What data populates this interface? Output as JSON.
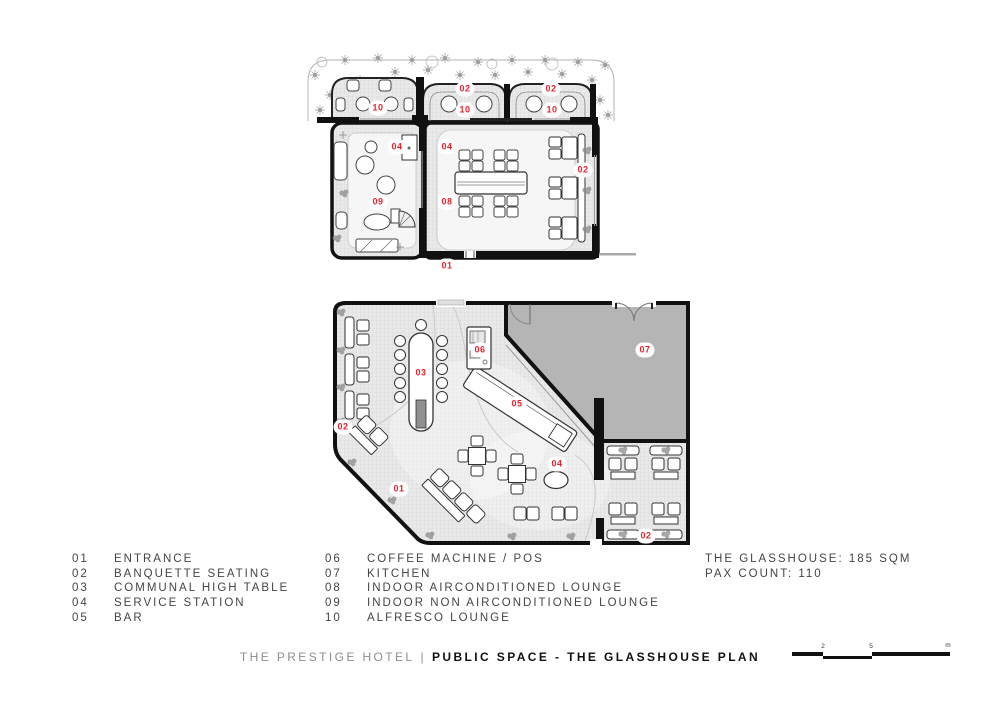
{
  "legend": {
    "items_left": [
      {
        "num": "01",
        "label": "ENTRANCE"
      },
      {
        "num": "02",
        "label": "BANQUETTE SEATING"
      },
      {
        "num": "03",
        "label": "COMMUNAL HIGH TABLE"
      },
      {
        "num": "04",
        "label": "SERVICE STATION"
      },
      {
        "num": "05",
        "label": "BAR"
      }
    ],
    "items_right": [
      {
        "num": "06",
        "label": "COFFEE MACHINE / POS"
      },
      {
        "num": "07",
        "label": "KITCHEN"
      },
      {
        "num": "08",
        "label": "INDOOR AIRCONDITIONED LOUNGE"
      },
      {
        "num": "09",
        "label": "INDOOR NON AIRCONDITIONED LOUNGE"
      },
      {
        "num": "10",
        "label": "ALFRESCO LOUNGE"
      }
    ]
  },
  "summary": {
    "area": "THE GLASSHOUSE: 185 SQM",
    "pax": "PAX COUNT: 110"
  },
  "footer": {
    "hotel": "THE PRESTIGE HOTEL",
    "separator": "|",
    "plan": "PUBLIC SPACE - THE GLASSHOUSE PLAN"
  },
  "scale_bar": {
    "tick1": "2",
    "tick2": "5",
    "unit": "m"
  },
  "markers": {
    "upper": [
      {
        "label": "10"
      },
      {
        "label": "02"
      },
      {
        "label": "10"
      },
      {
        "label": "02"
      },
      {
        "label": "10"
      },
      {
        "label": "04"
      },
      {
        "label": "04"
      },
      {
        "label": "09"
      },
      {
        "label": "08"
      },
      {
        "label": "02"
      },
      {
        "label": "01"
      }
    ],
    "lower": [
      {
        "label": "06"
      },
      {
        "label": "03"
      },
      {
        "label": "05"
      },
      {
        "label": "07"
      },
      {
        "label": "02"
      },
      {
        "label": "01"
      },
      {
        "label": "04"
      },
      {
        "label": "02"
      }
    ]
  },
  "colors": {
    "accent_red": "#E8232E",
    "wall": "#111111",
    "kitchen_fill": "#B5B5B5",
    "floor_fill": "#E9E9E9"
  }
}
